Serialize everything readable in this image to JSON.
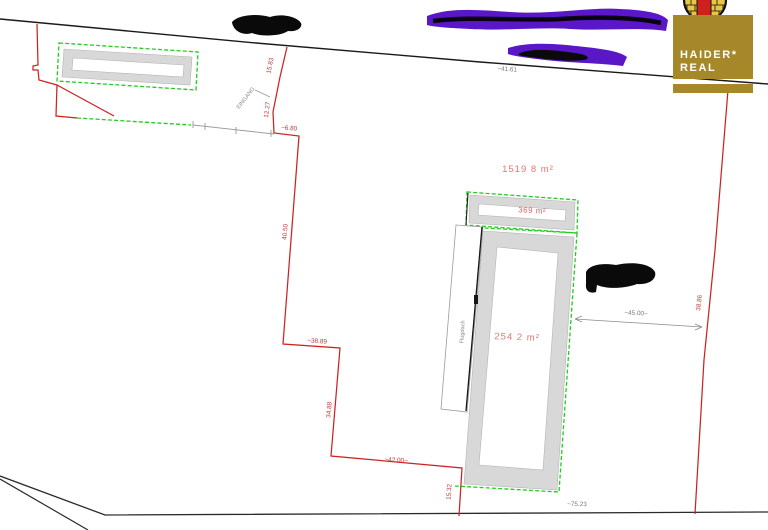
{
  "plan": {
    "area_labels": {
      "parcel_total": "1519 8 m²",
      "hall": "369 m²",
      "main_building": "254 2 m²"
    },
    "measurements": {
      "street_top": "~41.61",
      "entry_upper": "15.83",
      "entry_mid": "12.27",
      "entry_jog": "~6.80",
      "west_long": "40.50",
      "west_step": "~38.89",
      "west_lower": "34.88",
      "south_west": "~42.00~",
      "south_drop": "15.32",
      "south_base": "~75.23",
      "width_dim": "~45.00~",
      "east_edge": "38.86"
    },
    "annotations": {
      "entrance": "EINGANG",
      "canopy": "Flugdach"
    }
  },
  "logo": {
    "line1": "HAIDER*",
    "line2": "REAL",
    "box_color": "#a6882b",
    "emblem_gold": "#e9c545",
    "emblem_red": "#cf1f1f"
  },
  "colors": {
    "boundary_red": "#cc2222",
    "parcel_green": "#1ecf1e",
    "building_gray": "#d8d8d8",
    "redaction_purple": "#5a17c8",
    "area_text_red": "#e87474"
  }
}
